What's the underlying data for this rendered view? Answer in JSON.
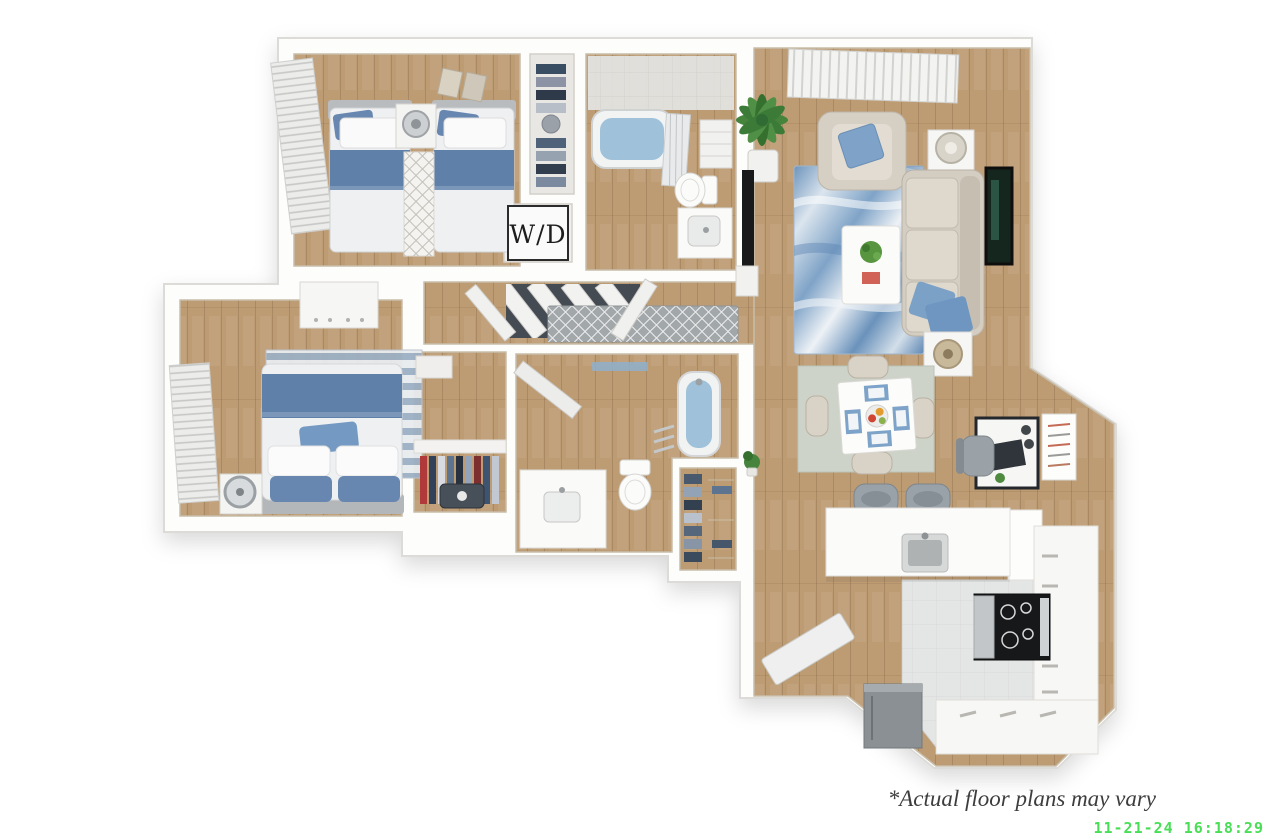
{
  "page": {
    "width": 1280,
    "height": 840,
    "background": "#ffffff"
  },
  "floor_plan": {
    "type": "3d-rendered top-down apartment floor plan",
    "bedrooms": 2,
    "bathrooms": 2,
    "rooms": [
      {
        "name": "bedroom-1",
        "furniture": [
          "twin bed left",
          "twin bed right",
          "nightstand with lamp",
          "runner rug",
          "window blinds",
          "wall art"
        ]
      },
      {
        "name": "closet-1",
        "furniture": [
          "shelves with folded clothes"
        ]
      },
      {
        "name": "laundry-closet",
        "furniture": [
          "washer dryer sign"
        ]
      },
      {
        "name": "bathroom-1",
        "furniture": [
          "bathtub with shower curtain",
          "tiled shower wall",
          "linen shelf",
          "toilet",
          "vanity sink"
        ]
      },
      {
        "name": "hallway",
        "furniture": [
          "runner rug",
          "open doors",
          "bifold closet doors"
        ]
      },
      {
        "name": "bedroom-2",
        "furniture": [
          "queen bed with blue bedding",
          "nightstand with round lamp",
          "striped rug",
          "dresser",
          "window blinds"
        ]
      },
      {
        "name": "closet-2",
        "furniture": [
          "hanging clothes",
          "shelf",
          "suitcase",
          "storage box"
        ]
      },
      {
        "name": "bathroom-2",
        "furniture": [
          "bathtub",
          "toilet",
          "vanity sink",
          "towel rack",
          "ceiling light"
        ]
      },
      {
        "name": "walk-in-closet",
        "furniture": [
          "shelves with clothes and shoes"
        ]
      },
      {
        "name": "living-room",
        "furniture": [
          "sofa with blue pillows",
          "armchair with blue pillow",
          "blue marble area rug",
          "coffee table with plant",
          "end table with lamp",
          "end table with basket lamp",
          "tv with stand",
          "potted palm",
          "window blinds",
          "framed wall art"
        ]
      },
      {
        "name": "dining-area",
        "furniture": [
          "square table",
          "four chairs",
          "four blue placemats",
          "fruit bowl",
          "sage area rug"
        ]
      },
      {
        "name": "desk-nook",
        "furniture": [
          "desk with laptop",
          "office chair",
          "framed wall poster"
        ]
      },
      {
        "name": "kitchen",
        "furniture": [
          "island with sink",
          "two bar stools",
          "range with black cooktop",
          "refrigerator",
          "white cabinets",
          "tile floor"
        ]
      },
      {
        "name": "entry",
        "furniture": [
          "open front door"
        ]
      }
    ]
  },
  "labels": {
    "washer_dryer": "W/D",
    "disclaimer": "*Actual floor plans may vary",
    "timestamp": "11-21-24 16:18:29"
  },
  "colors": {
    "wall": "#fdfdfc",
    "wood_floor": "#bd9c74",
    "tile_floor": "#e4e6e5",
    "accent_blue": "#6787b0",
    "rug_blue": "#7fa3c7",
    "sofa_beige": "#d4cdc2",
    "plant_green": "#46833d",
    "appliance_gray": "#8b9094",
    "timestamp_green": "#3fdd4c",
    "disclaimer_text": "#3d3d3d"
  }
}
